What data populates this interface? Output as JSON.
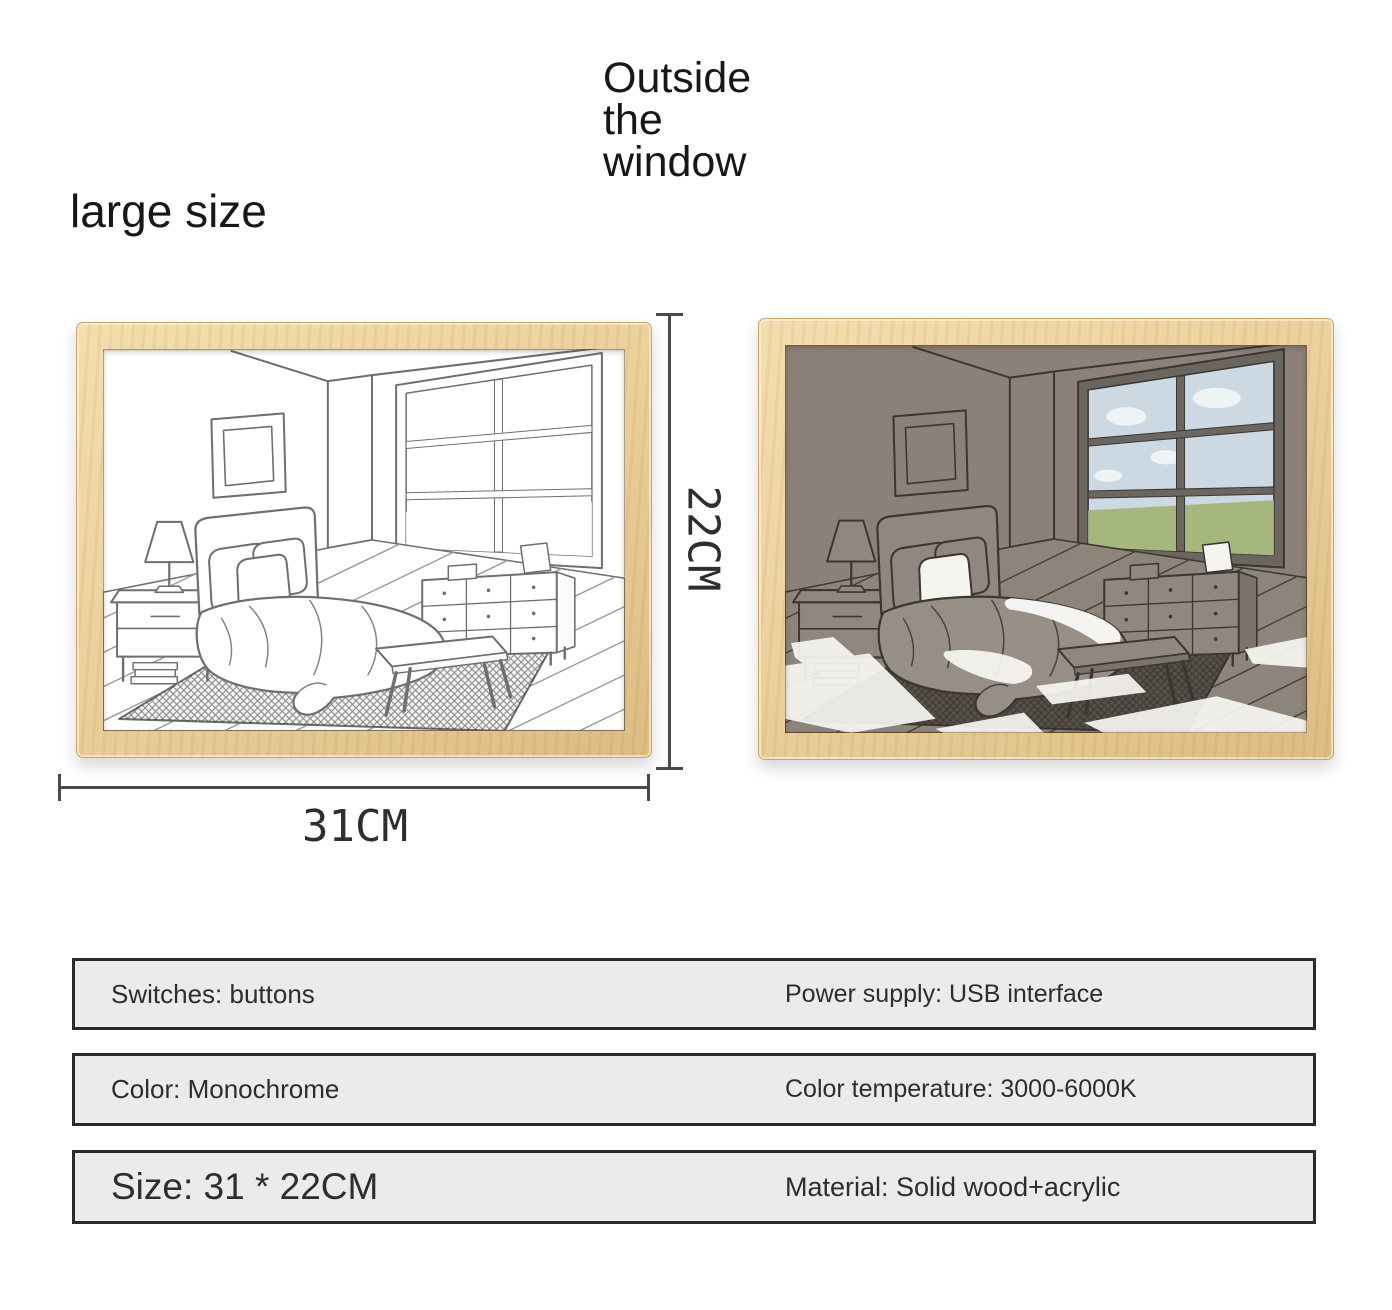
{
  "header": {
    "title": "Outside the window",
    "size_label": "large size"
  },
  "product": {
    "dimensions": {
      "height_label": "22CM",
      "width_label": "31CM"
    },
    "frames": [
      {
        "variant": "sketch-light-off"
      },
      {
        "variant": "illuminated-light-on"
      }
    ]
  },
  "specs": {
    "rows": [
      {
        "left": "Switches: buttons",
        "right": "Power supply: USB interface"
      },
      {
        "left": "Color: Monochrome",
        "right": "Color temperature: 3000-6000K"
      },
      {
        "left": "Size: 31 * 22CM",
        "right": "Material: Solid wood+acrylic"
      }
    ]
  },
  "colors": {
    "wood_frame": "#ecd19d",
    "lit_wall": "#8b8179",
    "window_sky": "#ccd8e2",
    "window_grass": "#a5b77d",
    "spec_box_bg": "#ecebe9",
    "spec_box_border": "#2b2b2b",
    "dimension_line": "#4a4a4a",
    "text": "#171717"
  }
}
